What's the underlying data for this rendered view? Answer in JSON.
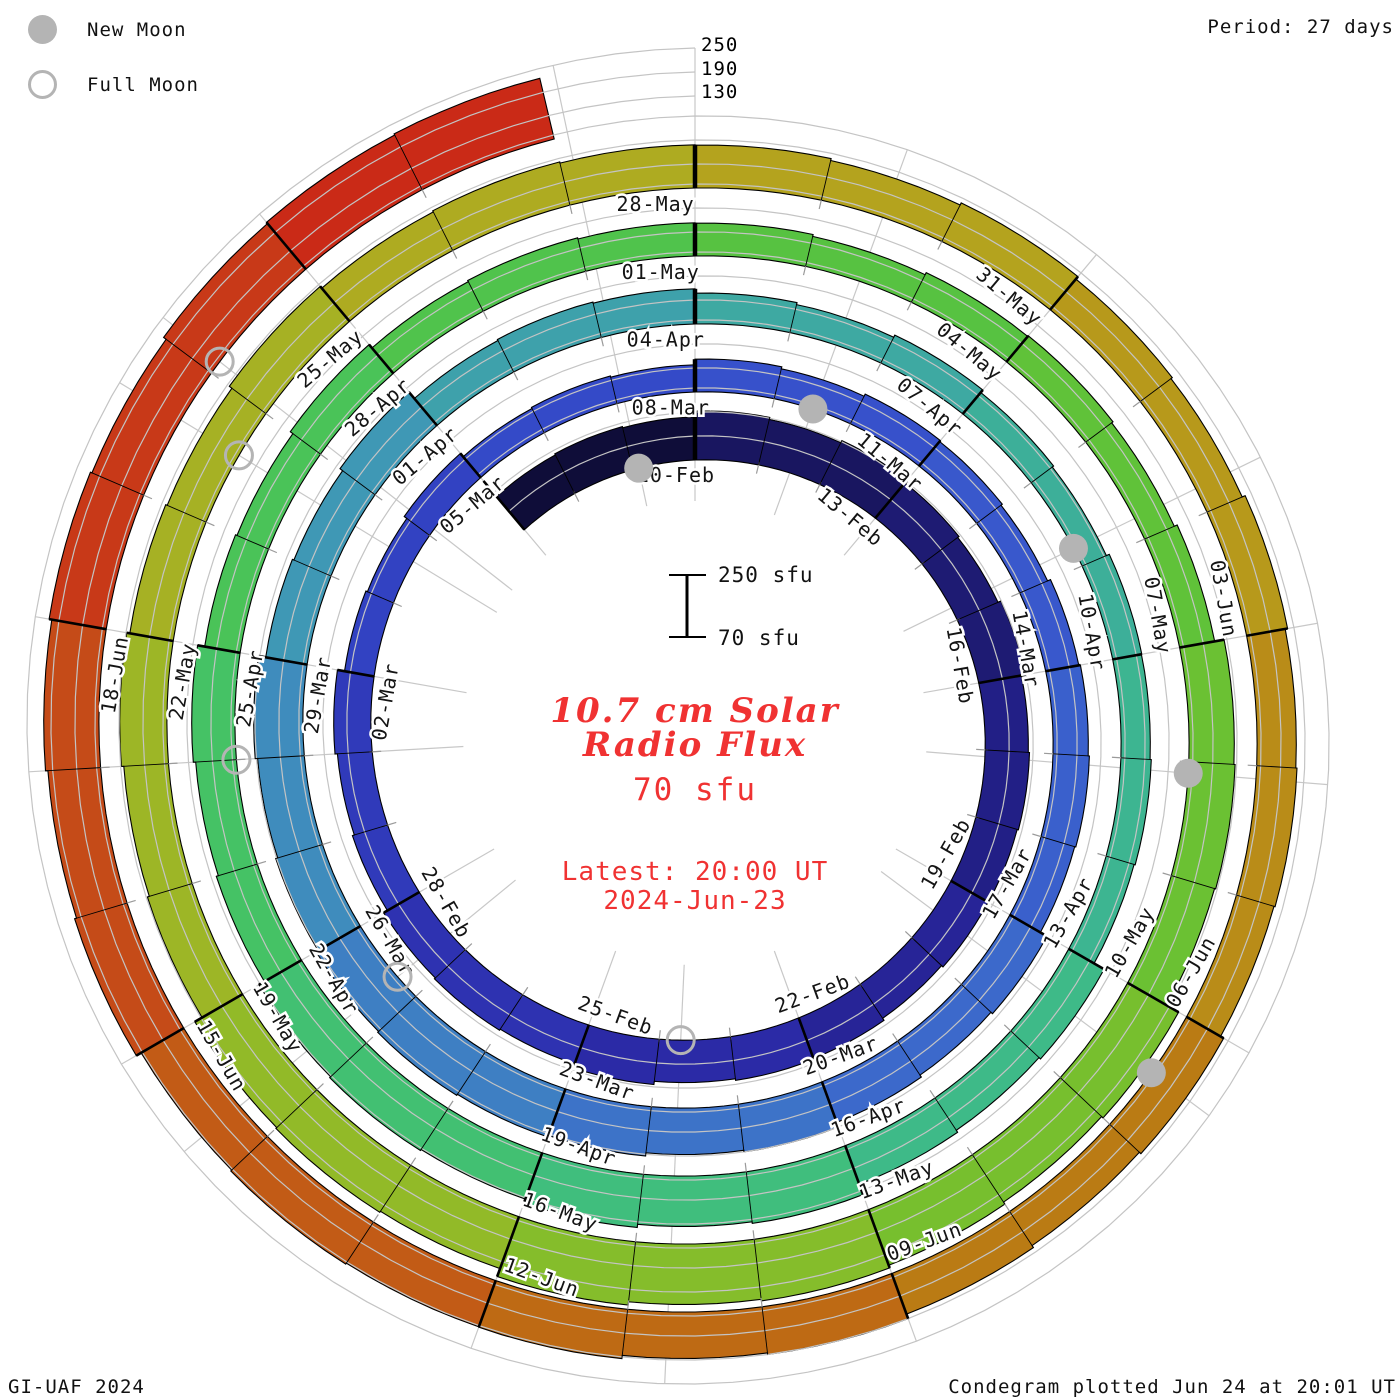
{
  "legend": {
    "new_moon_label": "New Moon",
    "full_moon_label": "Full Moon"
  },
  "header": {
    "period_label": "Period: 27 days"
  },
  "radial_axis_labels": [
    "250",
    "190",
    "130"
  ],
  "scale_bar": {
    "top_label": "250 sfu",
    "bottom_label": "70 sfu"
  },
  "center": {
    "title_line1": "10.7 cm Solar",
    "title_line2": "Radio Flux",
    "flux_floor_label": "70 sfu",
    "latest_line1": "Latest: 20:00 UT",
    "latest_line2": "2024-Jun-23",
    "accent_color": "#f03232"
  },
  "footer": {
    "left": "GI-UAF 2024",
    "right": "Condegram plotted Jun 24 at 20:01 UT"
  },
  "chart_data": {
    "type": "bar",
    "subtype": "condegram_spiral_bar",
    "title": "10.7 cm Solar Radio Flux",
    "units": "sfu",
    "period_days": 27,
    "baseline_sfu": 70,
    "max_scale_sfu": 250,
    "grid_levels_sfu": [
      130,
      190,
      250
    ],
    "day0_date": "2024-Feb-10",
    "start_day_offset": -3,
    "end_day_offset": 134,
    "latest_reading": "2024-Jun-23 20:00 UT",
    "segment_block_days": 3,
    "segment_dates": [
      "07-Feb",
      "10-Feb",
      "13-Feb",
      "16-Feb",
      "19-Feb",
      "22-Feb",
      "25-Feb",
      "28-Feb",
      "02-Mar",
      "05-Mar",
      "08-Mar",
      "11-Mar",
      "14-Mar",
      "17-Mar",
      "20-Mar",
      "23-Mar",
      "26-Mar",
      "29-Mar",
      "01-Apr",
      "04-Apr",
      "07-Apr",
      "10-Apr",
      "13-Apr",
      "16-Apr",
      "19-Apr",
      "22-Apr",
      "25-Apr",
      "28-Apr",
      "01-May",
      "04-May",
      "07-May",
      "10-May",
      "13-May",
      "16-May",
      "19-May",
      "22-May",
      "25-May",
      "28-May",
      "31-May",
      "03-Jun",
      "06-Jun",
      "09-Jun",
      "12-Jun",
      "15-Jun",
      "18-Jun",
      "21-Jun"
    ],
    "segment_flux_sfu": [
      180,
      190,
      185,
      180,
      175,
      180,
      175,
      160,
      145,
      140,
      150,
      150,
      160,
      175,
      190,
      200,
      190,
      175,
      160,
      145,
      140,
      145,
      170,
      200,
      195,
      175,
      160,
      155,
      150,
      155,
      185,
      215,
      225,
      210,
      185,
      180,
      180,
      175,
      170,
      170,
      175,
      190,
      195,
      205,
      215,
      225
    ],
    "unlabeled_segments": [
      "07-Feb",
      "21-Jun"
    ],
    "moons": {
      "new": [
        {
          "date": "09-Feb",
          "day_offset": -0.9
        },
        {
          "date": "10-Mar",
          "day_offset": 28.5
        },
        {
          "date": "08-Apr",
          "day_offset": 58.8
        },
        {
          "date": "08-May",
          "day_offset": 88.1
        },
        {
          "date": "06-Jun",
          "day_offset": 117.5
        }
      ],
      "full": [
        {
          "date": "24-Feb",
          "day_offset": 13.7
        },
        {
          "date": "25-Mar",
          "day_offset": 44.3
        },
        {
          "date": "23-Apr",
          "day_offset": 74.0
        },
        {
          "date": "23-May",
          "day_offset": 103.6
        },
        {
          "date": "21-Jun",
          "day_offset": 131.1
        }
      ]
    },
    "color_stops": [
      [
        -3,
        "#07071c"
      ],
      [
        0,
        "#161356"
      ],
      [
        6,
        "#201d7d"
      ],
      [
        12,
        "#2926a0"
      ],
      [
        18,
        "#2f36b6"
      ],
      [
        24,
        "#3346c6"
      ],
      [
        30,
        "#3854cc"
      ],
      [
        36,
        "#3b64cc"
      ],
      [
        42,
        "#3d78c6"
      ],
      [
        48,
        "#3f93ba"
      ],
      [
        54,
        "#3ea6a6"
      ],
      [
        60,
        "#3cb295"
      ],
      [
        66,
        "#3fbd83"
      ],
      [
        72,
        "#43c16c"
      ],
      [
        78,
        "#4cc351"
      ],
      [
        84,
        "#5ac23c"
      ],
      [
        90,
        "#70c030"
      ],
      [
        96,
        "#8cbc29"
      ],
      [
        102,
        "#a2b425"
      ],
      [
        108,
        "#b2a81f"
      ],
      [
        114,
        "#b9941a"
      ],
      [
        117,
        "#b98415"
      ],
      [
        120,
        "#bb7113"
      ],
      [
        123,
        "#c06215"
      ],
      [
        126,
        "#c45317"
      ],
      [
        129,
        "#c64218"
      ],
      [
        132,
        "#c93018"
      ],
      [
        134,
        "#ca2415"
      ]
    ],
    "grid_color": "#c4c4c4",
    "spoke_color": "#c8c8c8",
    "moon_marker_color": "#b4b4b4",
    "divider_color": "#000000",
    "label_color": "#141414",
    "legend_position": "top-left",
    "grid_on": true
  }
}
